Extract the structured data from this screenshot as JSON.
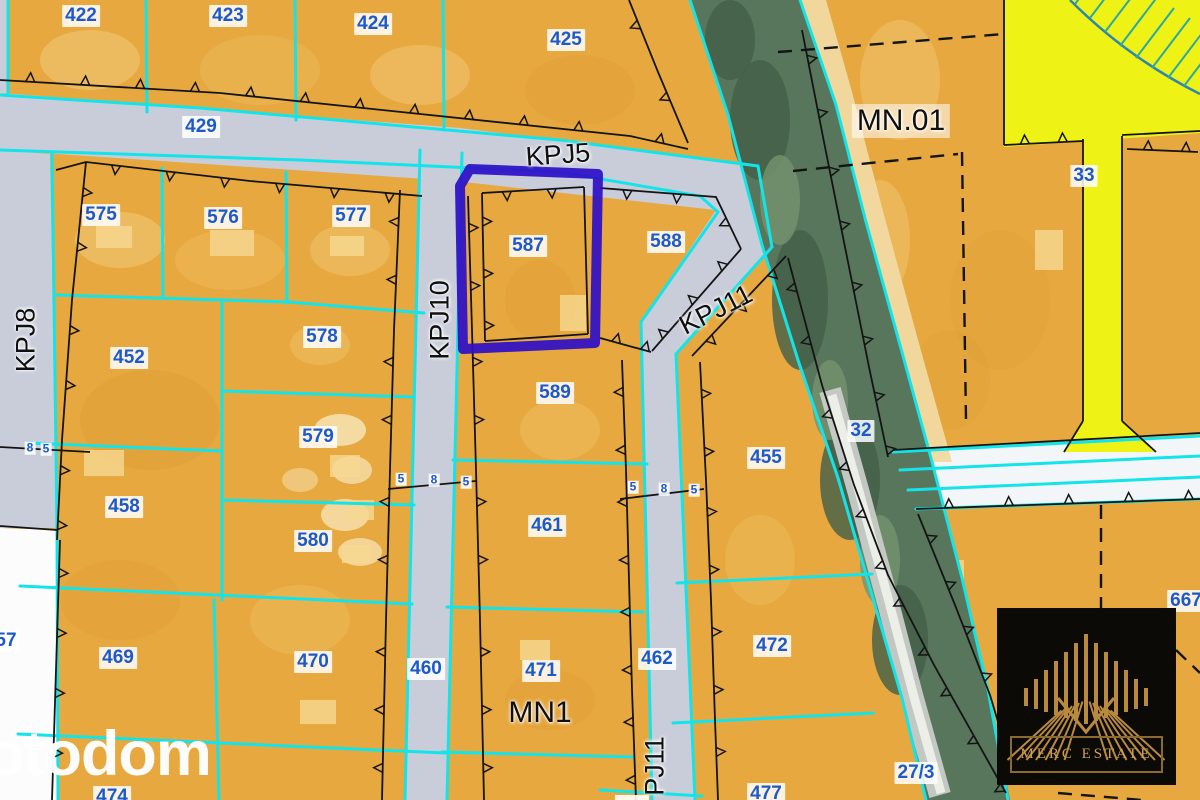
{
  "map": {
    "highlighted_parcel": "587",
    "colors": {
      "parcel_orange": "#e7a840",
      "parcel_light": "#f4cd7d",
      "road_gray": "#c9cdda",
      "road_white": "#f3f6f8",
      "boundary_cyan": "#12e4e9",
      "line_black": "#141414",
      "highlight_blue": "#2e0fc6",
      "label_blue": "#1d5ac9",
      "zone_yellow": "#eef315",
      "hatch_teal": "#2aa9a2",
      "hatch_curve_blue": "#2f86ac",
      "vegetation_green": "#57765b",
      "sand": "#f2d9a2",
      "blank_white": "#fcfcfc",
      "logo_gold": "#b98a3e",
      "logo_bg": "#0c0a07"
    },
    "parcel_labels": [
      {
        "text": "422",
        "x": 81,
        "y": 16
      },
      {
        "text": "423",
        "x": 228,
        "y": 16
      },
      {
        "text": "424",
        "x": 373,
        "y": 24
      },
      {
        "text": "425",
        "x": 566,
        "y": 40
      },
      {
        "text": "429",
        "x": 201,
        "y": 127
      },
      {
        "text": "575",
        "x": 101,
        "y": 215
      },
      {
        "text": "576",
        "x": 223,
        "y": 218
      },
      {
        "text": "577",
        "x": 351,
        "y": 216
      },
      {
        "text": "587",
        "x": 528,
        "y": 246
      },
      {
        "text": "588",
        "x": 666,
        "y": 242
      },
      {
        "text": "452",
        "x": 129,
        "y": 358
      },
      {
        "text": "578",
        "x": 322,
        "y": 337
      },
      {
        "text": "589",
        "x": 555,
        "y": 393
      },
      {
        "text": "579",
        "x": 318,
        "y": 437
      },
      {
        "text": "580",
        "x": 313,
        "y": 541
      },
      {
        "text": "458",
        "x": 124,
        "y": 507
      },
      {
        "text": "455",
        "x": 766,
        "y": 458
      },
      {
        "text": "461",
        "x": 547,
        "y": 526
      },
      {
        "text": "32",
        "x": 861,
        "y": 431
      },
      {
        "text": "33",
        "x": 1084,
        "y": 176
      },
      {
        "text": "469",
        "x": 118,
        "y": 658
      },
      {
        "text": "470",
        "x": 313,
        "y": 662
      },
      {
        "text": "471",
        "x": 541,
        "y": 671
      },
      {
        "text": "461_dup_removed",
        "x": -100,
        "y": -100
      },
      {
        "text": "460",
        "x": 426,
        "y": 669
      },
      {
        "text": "462",
        "x": 657,
        "y": 659
      },
      {
        "text": "472",
        "x": 772,
        "y": 646
      },
      {
        "text": "57",
        "x": 6,
        "y": 641
      },
      {
        "text": "667",
        "x": 1186,
        "y": 601
      },
      {
        "text": "27/3",
        "x": 916,
        "y": 773
      },
      {
        "text": "474",
        "x": 112,
        "y": 797
      },
      {
        "text": "477",
        "x": 766,
        "y": 794
      }
    ],
    "dimension_labels": [
      {
        "text": "8",
        "x": 30,
        "y": 448
      },
      {
        "text": "5",
        "x": 46,
        "y": 449
      },
      {
        "text": "5",
        "x": 401,
        "y": 479
      },
      {
        "text": "8",
        "x": 434,
        "y": 480
      },
      {
        "text": "5",
        "x": 466,
        "y": 482
      },
      {
        "text": "5",
        "x": 633,
        "y": 487
      },
      {
        "text": "8",
        "x": 664,
        "y": 489
      },
      {
        "text": "5",
        "x": 694,
        "y": 490
      }
    ],
    "zone_labels": [
      {
        "text": "KPJ5",
        "x": 558,
        "y": 155,
        "rotate": -4,
        "size": 27,
        "chip": false
      },
      {
        "text": "KPJ8",
        "x": 26,
        "y": 340,
        "rotate": -90,
        "size": 27,
        "chip": false
      },
      {
        "text": "KPJ10",
        "x": 440,
        "y": 320,
        "rotate": -90,
        "size": 27,
        "chip": false
      },
      {
        "text": "KPJ11",
        "x": 716,
        "y": 310,
        "rotate": -27,
        "size": 27,
        "chip": false
      },
      {
        "text": "PJ11",
        "x": 655,
        "y": 766,
        "rotate": -90,
        "size": 27,
        "chip": false
      },
      {
        "text": "MN.01",
        "x": 901,
        "y": 121,
        "rotate": 0,
        "size": 30,
        "chip": true
      },
      {
        "text": "MN1",
        "x": 540,
        "y": 713,
        "rotate": 0,
        "size": 30,
        "chip": false
      }
    ]
  },
  "watermark": {
    "text": "otodom"
  },
  "logo": {
    "text": "MERC ESTATE"
  }
}
